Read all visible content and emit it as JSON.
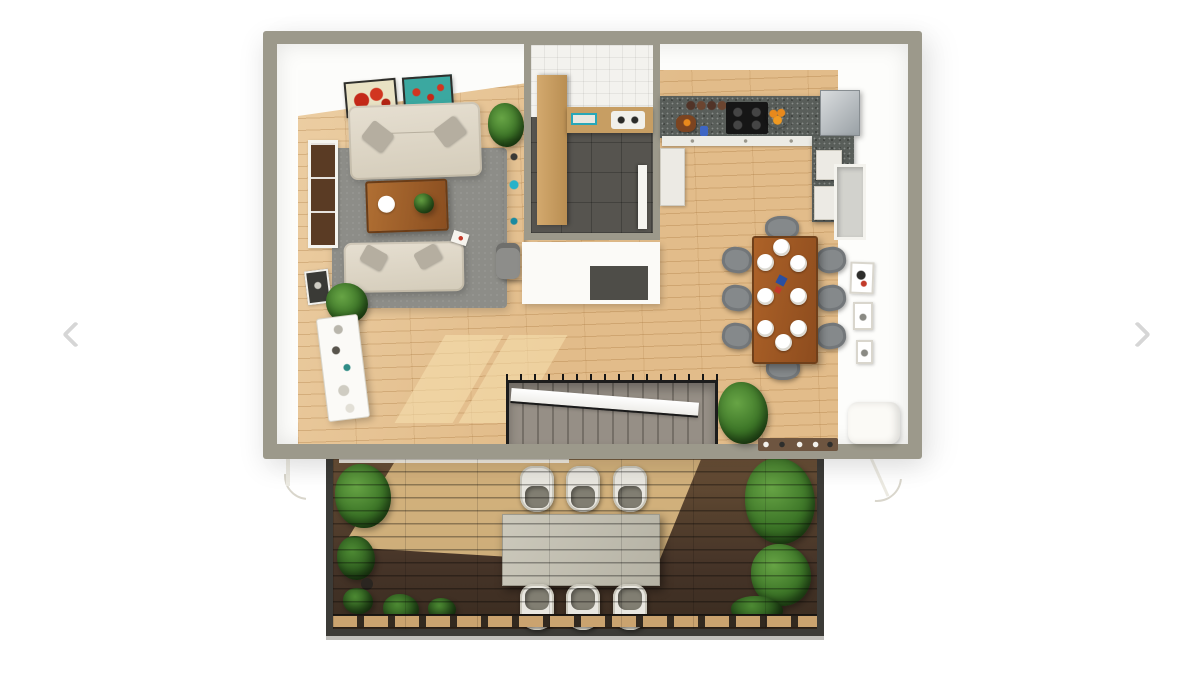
{
  "carousel": {
    "prev_icon": "chevron-left-icon",
    "next_icon": "chevron-right-icon",
    "arrow_color": "#d6d6d6",
    "background": "#ffffff"
  },
  "palette": {
    "exterior_wall": "#9c998b",
    "interior_wall": "#fdfdfb",
    "wood_floor": "#e2bc8a",
    "sunlit_floor": "#f4e0b4",
    "bathroom_floor": "#56544f",
    "kitchen_counter": "#595e5a",
    "rug": "#8d8d88",
    "sofa": "#ddd6c7",
    "coffee_table": "#9c5f2c",
    "dining_table": "#a05c28",
    "dining_chair": "#85898b",
    "stair_carpet": "#8d867e",
    "stair_railing": "#1c1c1c",
    "deck_wood": "#4a392a",
    "deck_sunlit": "#e9c88c",
    "deck_frame": "#3c3b37",
    "outdoor_table": "#c4c1b4",
    "outdoor_chair": "#e9e7e0",
    "plant_green": "#3c7527",
    "accent_orange": "#e8891c",
    "accent_red": "#c42818",
    "accent_teal": "#3ba8a0"
  },
  "floor_plan": {
    "view": "3d-top-down-render",
    "main_level": {
      "living_room": [
        "sofa",
        "sofa",
        "coffee-table",
        "rug",
        "sideboard",
        "potted-plant",
        "wall-art-poppies",
        "wall-art-teal",
        "window",
        "wall-frame",
        "magazine"
      ],
      "bathroom": [
        "tiled-wall",
        "wardrobe-cabinet",
        "vanity-sink",
        "towel-shelf",
        "door"
      ],
      "kitchen": [
        "l-shaped-counter",
        "cooktop",
        "spice-jars",
        "fruit-bowl",
        "cutting-board",
        "refrigerator",
        "dishwasher",
        "cabinet-fronts"
      ],
      "dining_area": [
        "dining-table",
        "plates-x8",
        "chairs-x8",
        "wall-frames-x3",
        "window",
        "napkins"
      ],
      "hallway": [
        "staircase",
        "potted-plant",
        "shoe-rack",
        "shelf-unit",
        "trash-can",
        "roller-blind"
      ]
    },
    "deck_level": {
      "outdoor_dining": [
        "outdoor-table",
        "chairs-x6"
      ],
      "planters": [
        "bushes-left",
        "palms-right",
        "small-plants",
        "planter-pot"
      ]
    }
  }
}
